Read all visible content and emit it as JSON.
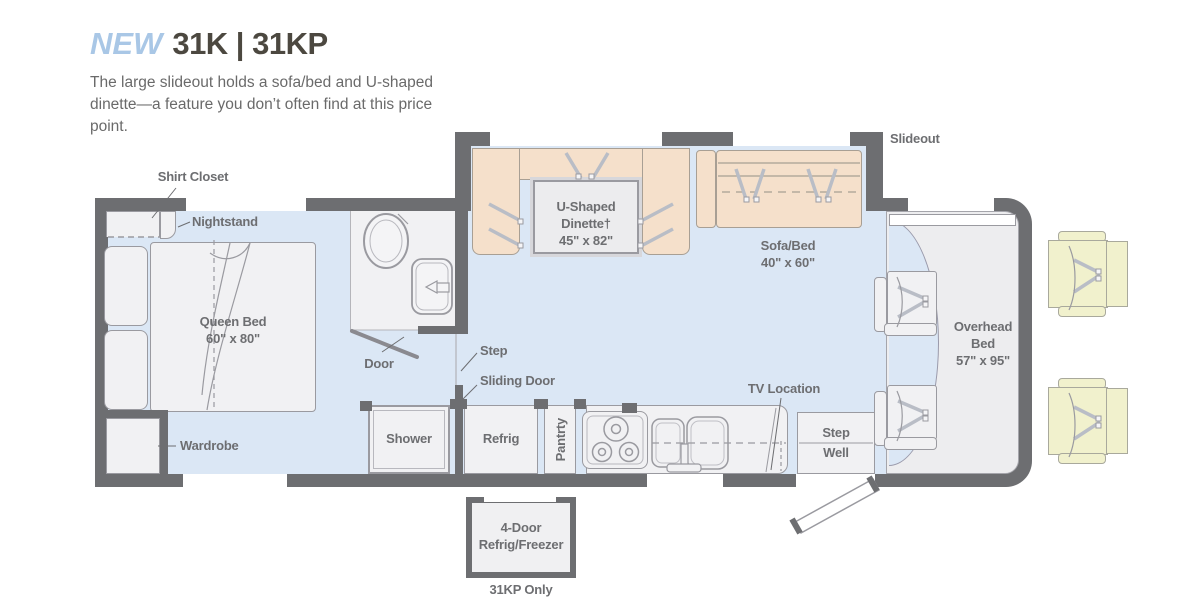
{
  "header": {
    "badge": "NEW",
    "model": "31K | 31KP",
    "description": "The large slideout holds a sofa/bed and U-shaped dinette—a feature you don’t often find at this price point."
  },
  "fp": {
    "slideout": "Slideout",
    "bedroom": {
      "shirt_closet": "Shirt Closet",
      "nightstand": "Nightstand",
      "bed1": "Queen Bed",
      "bed2": "60\" x 80\"",
      "wardrobe": "Wardrobe"
    },
    "bath": {
      "door": "Door",
      "shower": "Shower"
    },
    "hall": {
      "step": "Step",
      "sliding_door": "Sliding Door"
    },
    "kitchen": {
      "refrig": "Refrig",
      "pantry": "Pantrty",
      "tv": "TV Location"
    },
    "dinette": [
      "U-Shaped",
      "Dinette†",
      "45\" x 82\""
    ],
    "sofa": [
      "Sofa/Bed",
      "40\" x 60\""
    ],
    "cab": {
      "overhead": [
        "Overhead",
        "Bed",
        "57\" x 95\""
      ],
      "stepwell": [
        "Step",
        "Well"
      ]
    },
    "option": {
      "line1": "4-Door",
      "line2": "Refrig/Freezer",
      "note": "31KP Only"
    }
  },
  "colors": {
    "wall": "#6d6e71",
    "floor": "#dbe7f5",
    "furniture_tan": "#f5e0cb",
    "chair_yellow": "#f1f1cd",
    "accent_blue": "#a9c7e6",
    "label_gray": "#6d6e71"
  }
}
